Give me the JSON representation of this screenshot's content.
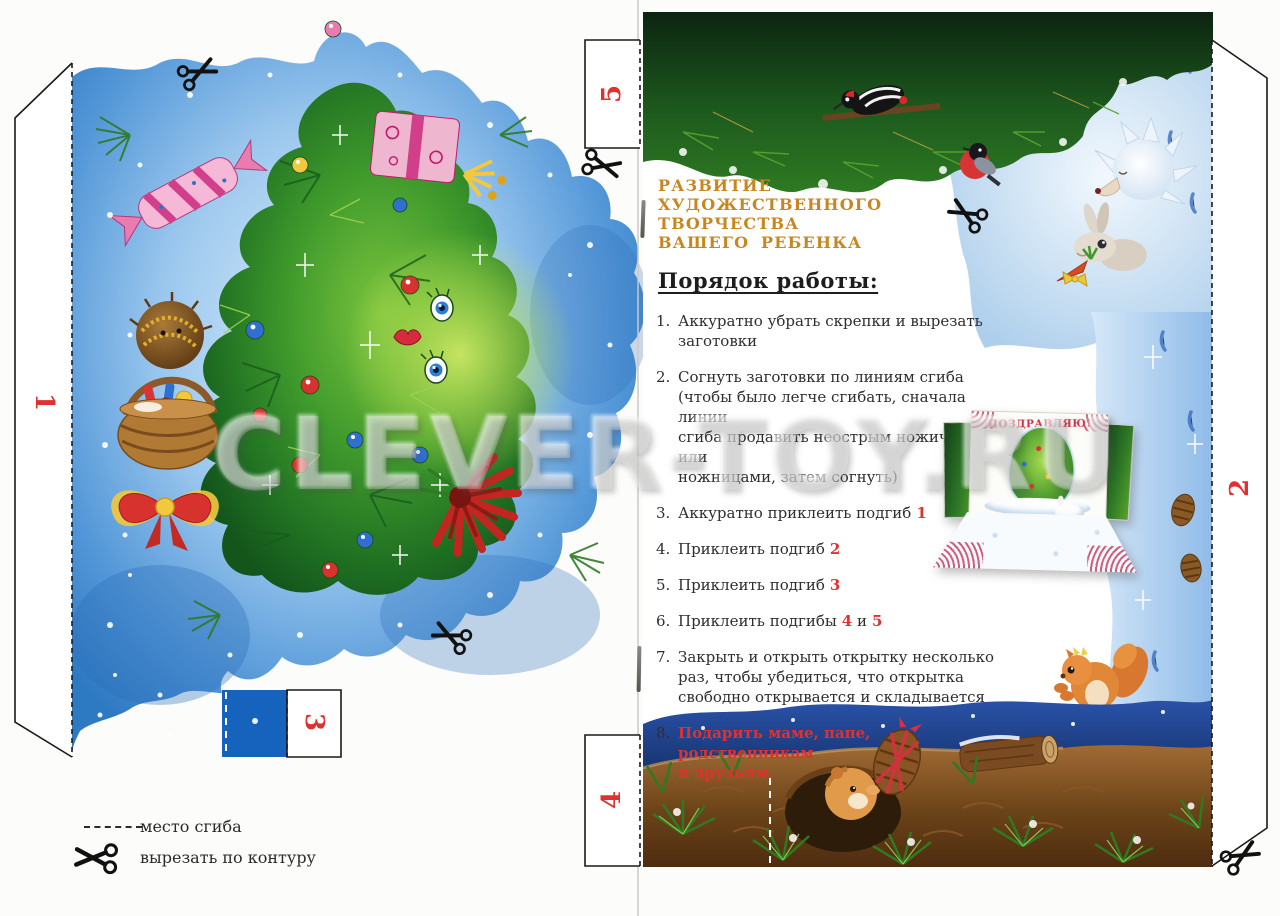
{
  "watermark": "CLEVER-TOY.RU",
  "header": {
    "line1": "РАЗВИТИЕ",
    "line2": "ХУДОЖЕСТВЕННОГО",
    "line3": "ТВОРЧЕСТВА",
    "line4": "ВАШЕГО РЕБЕНКА"
  },
  "instructions": {
    "title": "Порядок работы:",
    "items": [
      {
        "num": "1.",
        "segments": [
          {
            "text": "Аккуратно убрать скрепки и вырезать заготовки",
            "red": false
          }
        ]
      },
      {
        "num": "2.",
        "segments": [
          {
            "text": "Согнуть заготовки по линиям сгиба\n(чтобы было легче сгибать, сначала линии\nсгиба продавить неострым ножичком или\nножницами, затем согнуть)",
            "red": false
          }
        ]
      },
      {
        "num": "3.",
        "segments": [
          {
            "text": "Аккуратно приклеить подгиб",
            "red": false
          },
          {
            "text": "1",
            "red": true
          }
        ]
      },
      {
        "num": "4.",
        "segments": [
          {
            "text": "Приклеить подгиб",
            "red": false
          },
          {
            "text": "2",
            "red": true
          }
        ]
      },
      {
        "num": "5.",
        "segments": [
          {
            "text": "Приклеить подгиб",
            "red": false
          },
          {
            "text": "3",
            "red": true
          }
        ]
      },
      {
        "num": "6.",
        "segments": [
          {
            "text": "Приклеить подгибы",
            "red": false
          },
          {
            "text": "4",
            "red": true
          },
          {
            "text": " и",
            "red": false
          },
          {
            "text": "5",
            "red": true
          }
        ]
      },
      {
        "num": "7.",
        "segments": [
          {
            "text": "Закрыть и открыть открытку несколько\nраз, чтобы убедиться, что открытка\nсвободно открывается и складывается",
            "red": false
          }
        ]
      },
      {
        "num": "8.",
        "segments": [
          {
            "text": "Подарить маме, папе, родственникам\nи друзьям.",
            "red": true
          }
        ]
      }
    ]
  },
  "tabs": {
    "t1": "1",
    "t2": "2",
    "t3": "3",
    "t4": "4",
    "t5": "5"
  },
  "legend": {
    "fold": "место сгиба",
    "cut": "вырезать по контуру"
  },
  "card_photo": {
    "caption": "ПОЗДРАВЛЯЮ!"
  },
  "icons": {
    "scissors": "✂",
    "fold_line": "– – – –"
  },
  "colors": {
    "accent_red": "#e03131",
    "heading_orange": "#c9861f",
    "body_text": "#2e2e2e",
    "art_blue": "#4c93d6",
    "art_green": "#2f8f2a",
    "deep_blue": "#1663bd"
  }
}
